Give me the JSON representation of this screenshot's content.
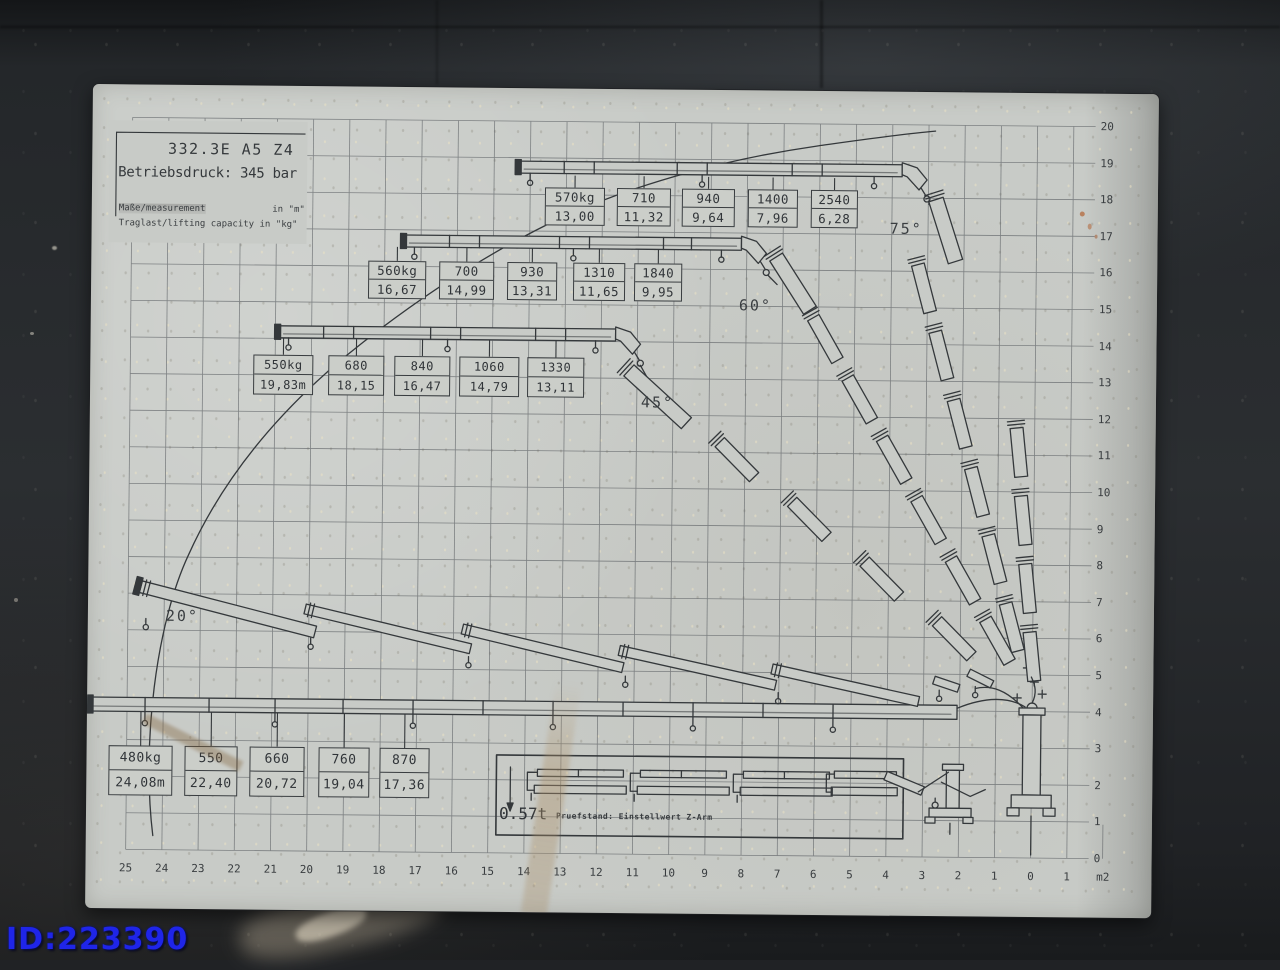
{
  "watermark": {
    "text": "ID:223390",
    "color": "#1f25e8"
  },
  "plate": {
    "model": "332.3E A5 Z4",
    "pressure_line": "Betriebsdruck: 345 bar",
    "measurement_note": "Maße/measurement",
    "measurement_unit": "in \"m\"",
    "capacity_note": "Traglast/lifting capacity in \"kg\"",
    "inset": {
      "weight": "0.57t",
      "caption": "Pruefstand: Einstellwert Z-Arm"
    }
  },
  "angle_labels": [
    "75°",
    "60°",
    "45°",
    "20°"
  ],
  "axes": {
    "right": [
      "20",
      "19",
      "18",
      "17",
      "16",
      "15",
      "14",
      "13",
      "12",
      "11",
      "10",
      "9",
      "8",
      "7",
      "6",
      "5",
      "4",
      "3",
      "2",
      "1",
      "0"
    ],
    "bottom": [
      "25",
      "24",
      "23",
      "22",
      "21",
      "20",
      "19",
      "18",
      "17",
      "16",
      "15",
      "14",
      "13",
      "12",
      "11",
      "10",
      "9",
      "8",
      "7",
      "6",
      "5",
      "4",
      "3",
      "2",
      "1",
      "0",
      "1",
      "m2"
    ]
  },
  "capacity_groups": [
    {
      "id": "extension-row-1",
      "boxes": [
        {
          "kg": "570kg",
          "m": "13,00"
        },
        {
          "kg": "710",
          "m": "11,32"
        },
        {
          "kg": "940",
          "m": "9,64"
        },
        {
          "kg": "1400",
          "m": "7,96"
        },
        {
          "kg": "2540",
          "m": "6,28"
        }
      ]
    },
    {
      "id": "extension-row-2",
      "boxes": [
        {
          "kg": "560kg",
          "m": "16,67"
        },
        {
          "kg": "700",
          "m": "14,99"
        },
        {
          "kg": "930",
          "m": "13,31"
        },
        {
          "kg": "1310",
          "m": "11,65"
        },
        {
          "kg": "1840",
          "m": "9,95"
        }
      ]
    },
    {
      "id": "extension-row-3",
      "boxes": [
        {
          "kg": "550kg",
          "m": "19,83m"
        },
        {
          "kg": "680",
          "m": "18,15"
        },
        {
          "kg": "840",
          "m": "16,47"
        },
        {
          "kg": "1060",
          "m": "14,79"
        },
        {
          "kg": "1330",
          "m": "13,11"
        }
      ]
    },
    {
      "id": "extension-row-4",
      "boxes": [
        {
          "kg": "480kg",
          "m": "24,08m"
        },
        {
          "kg": "550",
          "m": "22,40"
        },
        {
          "kg": "660",
          "m": "20,72"
        },
        {
          "kg": "760",
          "m": "19,04"
        },
        {
          "kg": "870",
          "m": "17,36"
        }
      ]
    }
  ],
  "chart_data": {
    "type": "line",
    "title": "332.3E A5 Z4 crane lifting capacity diagram",
    "subtitle": "Betriebsdruck: 345 bar",
    "xlabel": "outreach (m)",
    "ylabel": "height (m)",
    "x_range": [
      0,
      25
    ],
    "y_range": [
      0,
      20
    ],
    "grid": true,
    "boom_angle_lines_deg": [
      75,
      60,
      45,
      20
    ],
    "units": {
      "load": "kg",
      "distance": "m"
    },
    "series": [
      {
        "name": "upper extension row",
        "points_m_kg": [
          [
            13.0,
            570
          ],
          [
            11.32,
            710
          ],
          [
            9.64,
            940
          ],
          [
            7.96,
            1400
          ],
          [
            6.28,
            2540
          ]
        ]
      },
      {
        "name": "second extension row",
        "points_m_kg": [
          [
            16.67,
            560
          ],
          [
            14.99,
            700
          ],
          [
            13.31,
            930
          ],
          [
            11.65,
            1310
          ],
          [
            9.95,
            1840
          ]
        ]
      },
      {
        "name": "third extension row",
        "points_m_kg": [
          [
            19.83,
            550
          ],
          [
            18.15,
            680
          ],
          [
            16.47,
            840
          ],
          [
            14.79,
            1060
          ],
          [
            13.11,
            1330
          ]
        ]
      },
      {
        "name": "ground extension row",
        "points_m_kg": [
          [
            24.08,
            480
          ],
          [
            22.4,
            550
          ],
          [
            20.72,
            660
          ],
          [
            19.04,
            760
          ],
          [
            17.36,
            870
          ]
        ]
      }
    ],
    "inset_weight_t": 0.57
  }
}
